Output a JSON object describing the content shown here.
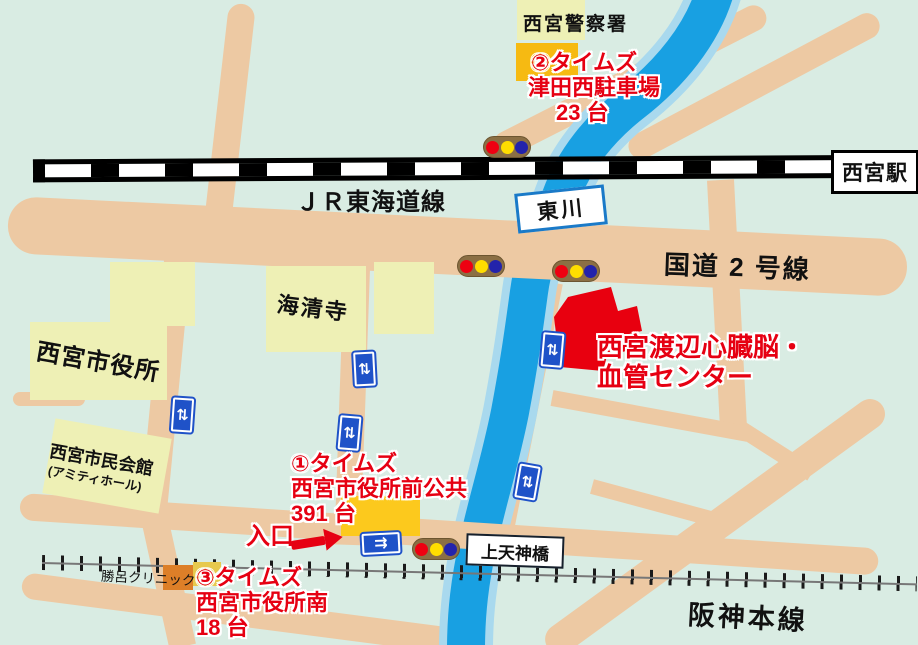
{
  "colors": {
    "background": "#d9ece3",
    "road": "#edc9a3",
    "river": "#18a0e2",
    "river_edge": "#a9d9ee",
    "building": "#eef0b5",
    "hospital_red": "#e8000f",
    "accent_red": "#e60012",
    "parking1_yellow": "#fcc91d",
    "parking2_yellow": "#f6ba12",
    "parking3_yellow": "#e7c94d",
    "clinic_orange": "#dd7f28",
    "signal_body": "#8b6f44",
    "signal_red": "#ee0011",
    "signal_yellow": "#ffdd00",
    "signal_blue": "#2323ab",
    "crosswalk_blue": "#1f52c8",
    "river_label_border": "#1a7ac8"
  },
  "labels": {
    "police_station": "西宮警察署",
    "jr_line": "ＪＲ東海道線",
    "station": "西宮駅",
    "river": "東川",
    "route2": "国道 2 号線",
    "city_hall": "西宮市役所",
    "temple": "海清寺",
    "civic_hall_line1": "西宮市民会館",
    "civic_hall_line2": "(アミティホール)",
    "clinic": "勝呂クリニック",
    "bridge": "上天神橋",
    "hanshin_line": "阪神本線",
    "hospital_line1": "西宮渡辺心臓脳・",
    "hospital_line2": "血管センター",
    "entrance": "入口"
  },
  "parkings": [
    {
      "line1": "①タイムズ",
      "line2": "西宮市役所前公共",
      "line3": "391 台"
    },
    {
      "line1": "②タイムズ",
      "line2": "津田西駐車場",
      "line3": "23 台"
    },
    {
      "line1": "③タイムズ",
      "line2": "西宮市役所南",
      "line3": "18 台"
    }
  ],
  "icons": {
    "crosswalk": "⇅",
    "one_way": "⇉"
  }
}
